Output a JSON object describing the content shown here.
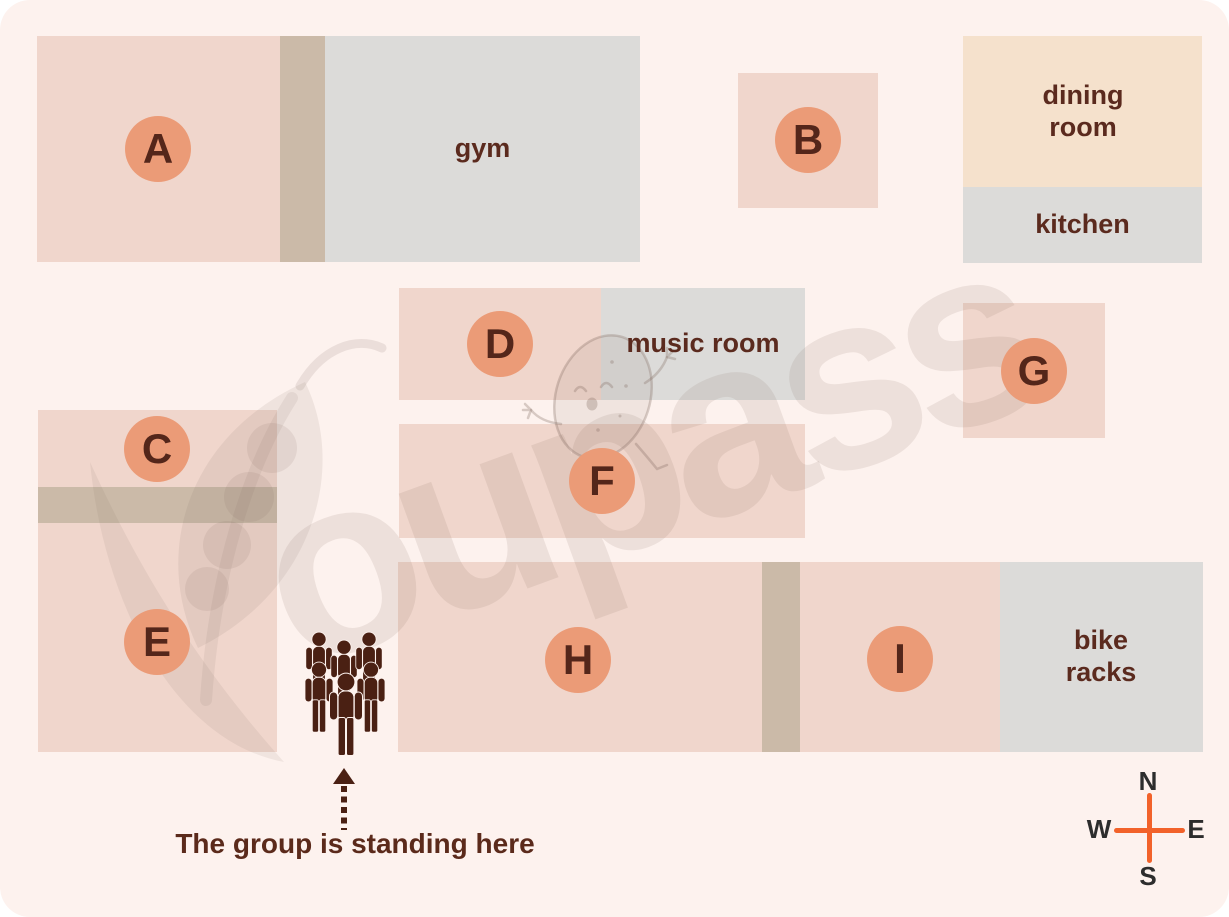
{
  "map": {
    "buildings": [
      {
        "label": "A"
      },
      {
        "label": "B"
      },
      {
        "label": "C"
      },
      {
        "label": "D"
      },
      {
        "label": "E"
      },
      {
        "label": "F"
      },
      {
        "label": "G"
      },
      {
        "label": "H"
      },
      {
        "label": "I"
      }
    ],
    "rooms": {
      "gym": "gym",
      "dining_room": "dining room",
      "kitchen": "kitchen",
      "music_room": "music room",
      "bike_racks": "bike racks"
    },
    "annotation": "The group is standing here",
    "compass": {
      "north": "N",
      "east": "E",
      "south": "S",
      "west": "W"
    },
    "watermark": "oupass"
  },
  "colors": {
    "background": "#fdf2ee",
    "building_pink": "#f0d6cc",
    "connector_tan": "#cbbaa8",
    "room_gray": "#dcdbd9",
    "dining_beige": "#f5e1cc",
    "badge_salmon": "#eb9b77",
    "badge_letter_brown": "#54261a",
    "label_brown": "#5b2a1e",
    "group_icon_brown": "#4a2013",
    "compass_orange": "#f2622a"
  }
}
